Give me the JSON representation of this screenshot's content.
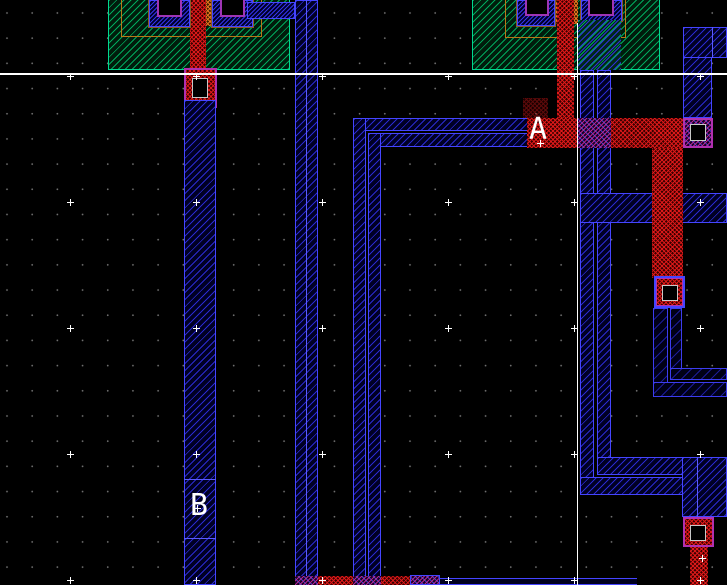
{
  "canvas": {
    "labels": {
      "a": "A",
      "b": "B"
    },
    "colors": {
      "background": "#000000",
      "metal1_blue": "#4545ff",
      "poly_red": "#e41a1a",
      "diffusion_green": "#00d890",
      "well_outline_orange": "#b87818",
      "via_purple": "#b030b0",
      "overlap_purple": "#c42896",
      "grid_dot_gray": "#6f6f6f",
      "axis_white": "#ffffff"
    }
  }
}
